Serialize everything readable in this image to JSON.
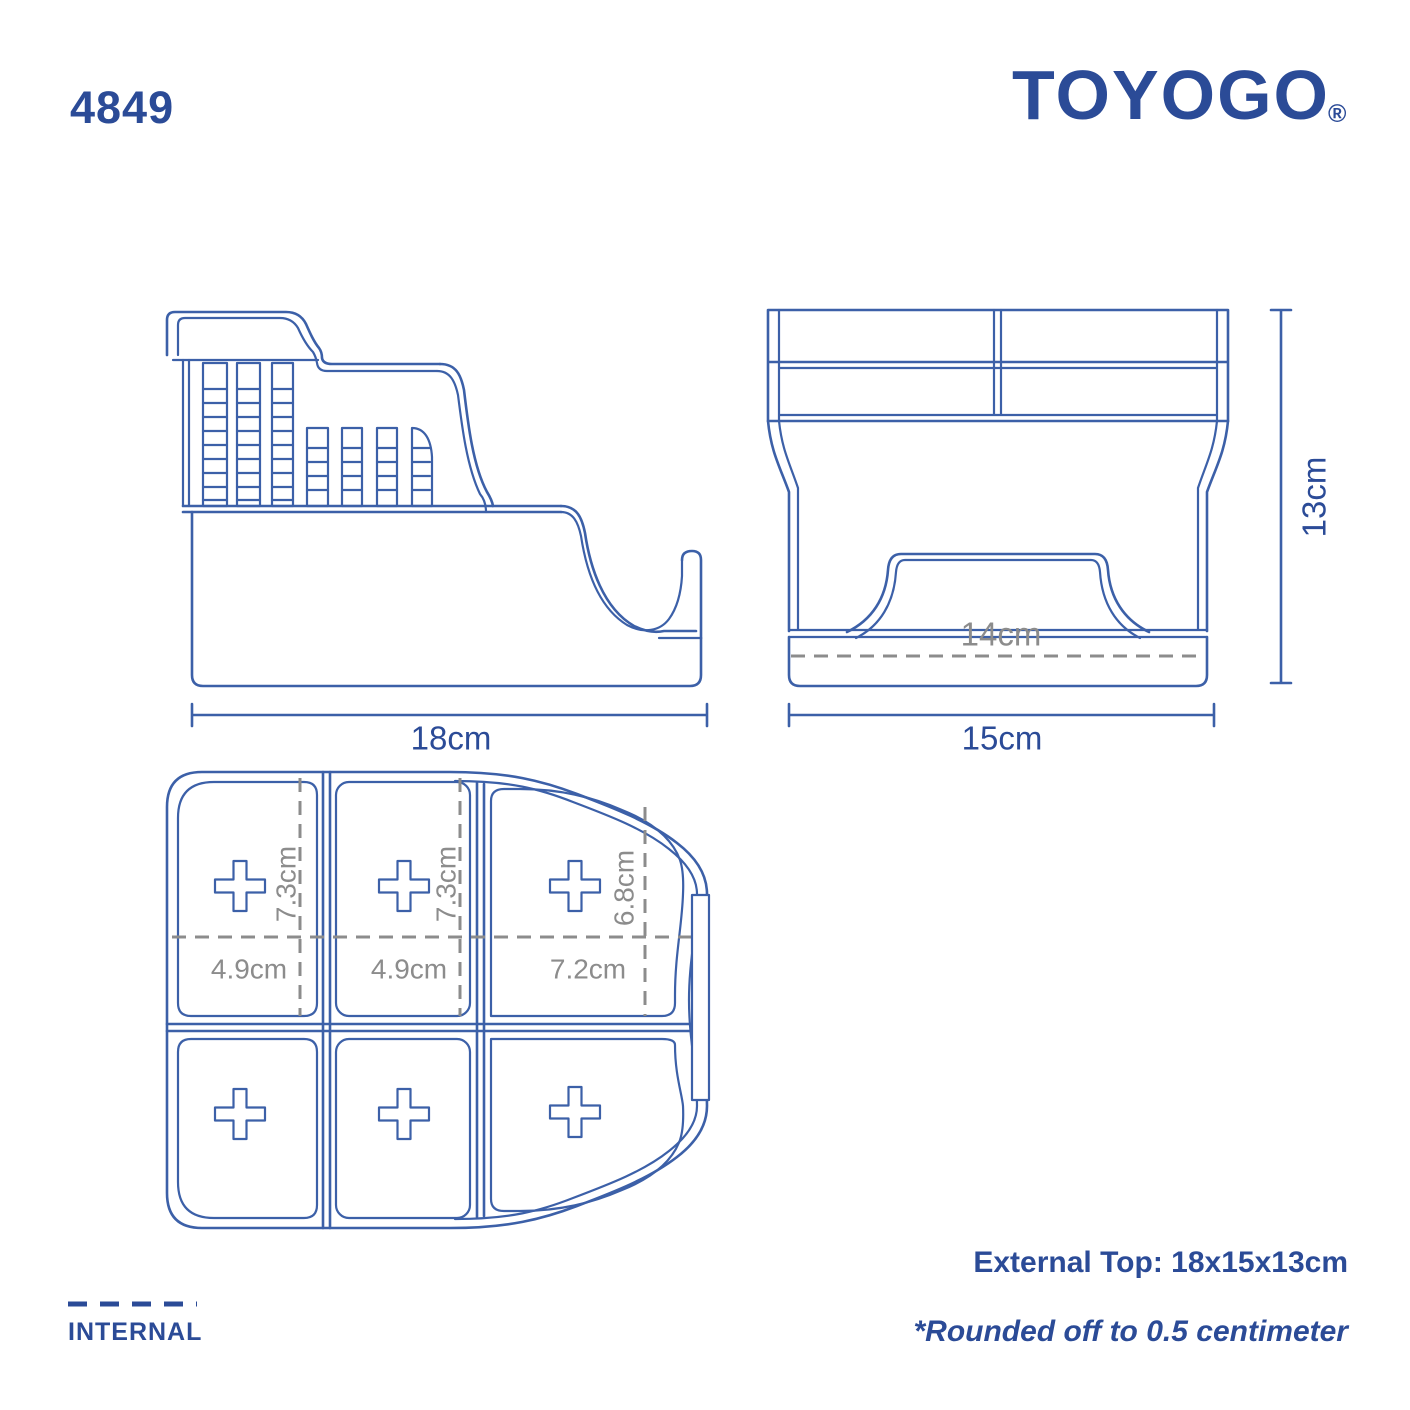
{
  "header": {
    "product_code": "4849",
    "brand": "TOYOGO",
    "registered_mark": "®"
  },
  "views": {
    "side": {
      "width_label": "18cm"
    },
    "front": {
      "width_label": "15cm",
      "height_label": "13cm",
      "internal_width_label": "14cm"
    },
    "top": {
      "compartments": [
        {
          "depth_label": "7.3cm",
          "width_label": "4.9cm"
        },
        {
          "depth_label": "7.3cm",
          "width_label": "4.9cm"
        },
        {
          "depth_label": "6.8cm",
          "width_label": "7.2cm"
        }
      ]
    }
  },
  "legend": {
    "internal_label": "INTERNAL"
  },
  "notes": {
    "external_dimensions": "External Top: 18x15x13cm",
    "rounding_note": "*Rounded off to 0.5 centimeter"
  },
  "colors": {
    "line_blue": "#3c60a8",
    "text_blue": "#2b4b97",
    "dim_gray": "#8c8c8c"
  }
}
